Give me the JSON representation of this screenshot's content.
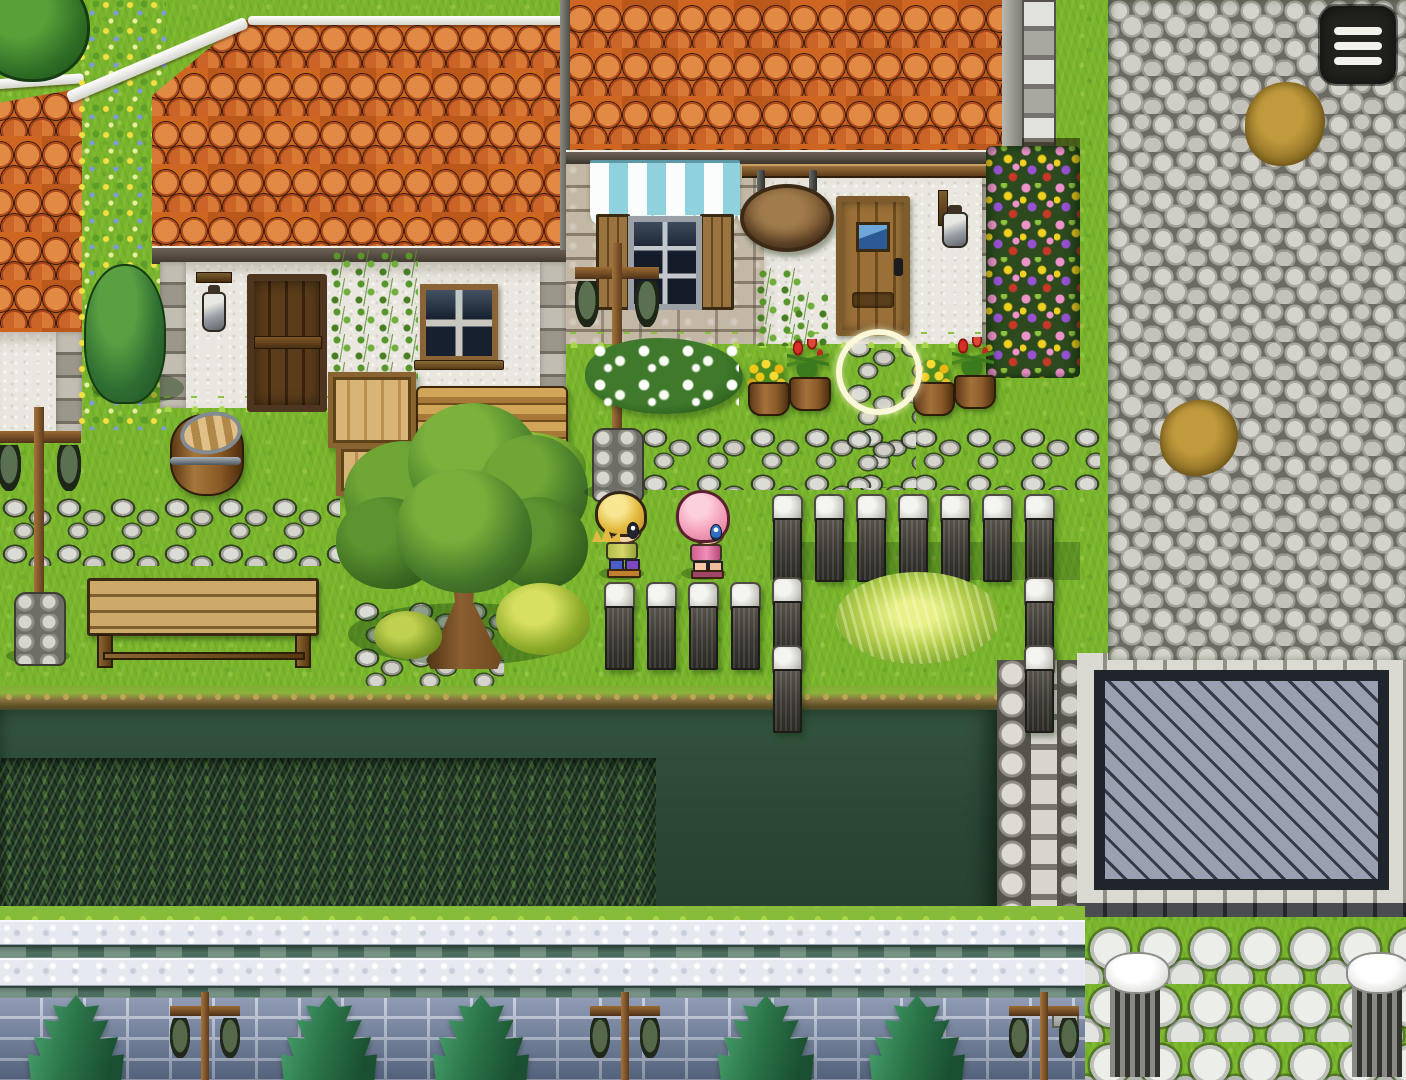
{
  "app": {
    "title": "Top-down RPG village exterior (touch-controlled)",
    "genre": "2D RPG town map"
  },
  "hud": {
    "menu_button": {
      "label": "Menu",
      "icon": "hamburger-menu-icon",
      "bar_count": 3,
      "bg_color": "#23231e",
      "bar_color": "#f2f2ea"
    },
    "touch_indicator": {
      "shape": "circle-ring",
      "x": 836,
      "y": 329,
      "size": 86,
      "color": "#fbf8da"
    }
  },
  "characters": [
    {
      "id": "boy",
      "label": "blond-haired boy villager",
      "facing": "right",
      "x": 594,
      "y": 490,
      "hair_color": "#e3ba41",
      "outfit_color": "#c3cc58"
    },
    {
      "id": "girl",
      "label": "pink-haired girl villager",
      "facing": "right",
      "x": 676,
      "y": 490,
      "hair_color": "#f4a0ba",
      "outfit_color": "#e87aa8"
    }
  ],
  "palette": {
    "grass": "#7ab42e",
    "grass_light": "#9ccf44",
    "grass_dark": "#5c941f",
    "roof": "#c8601f",
    "stucco": "#e9e7df",
    "stone_light": "#d2d2cb",
    "stone_dark": "#62625a",
    "wood": "#8a5d2e",
    "wood_dark": "#4e3318",
    "awning": "#8fd2de",
    "pond": "#2c4a37",
    "crops": "#24392a",
    "brick": "#70809f",
    "canal": "#4c6e60",
    "courtyard": "#98a0b0",
    "pine": "#2a7247",
    "skin": "#f7d4a8",
    "ui_dark": "#23231e",
    "ui_light": "#f2f2ea",
    "ring": "#fbf8da",
    "boy_hair": "#e3ba41",
    "girl_hair": "#f4a0ba"
  },
  "entities": {
    "fence_posts": [
      {
        "x": 772,
        "y": 494
      },
      {
        "x": 814,
        "y": 494
      },
      {
        "x": 856,
        "y": 494
      },
      {
        "x": 898,
        "y": 494
      },
      {
        "x": 940,
        "y": 494
      },
      {
        "x": 982,
        "y": 494
      },
      {
        "x": 1024,
        "y": 494
      },
      {
        "x": 772,
        "y": 577
      },
      {
        "x": 772,
        "y": 645
      },
      {
        "x": 1024,
        "y": 577
      },
      {
        "x": 1024,
        "y": 645
      },
      {
        "x": 604,
        "y": 582
      },
      {
        "x": 646,
        "y": 582
      },
      {
        "x": 688,
        "y": 582
      },
      {
        "x": 730,
        "y": 582
      }
    ],
    "bottom_trees": [
      {
        "x": 28,
        "y": 995
      },
      {
        "x": 281,
        "y": 995
      },
      {
        "x": 433,
        "y": 995
      },
      {
        "x": 718,
        "y": 995
      },
      {
        "x": 869,
        "y": 995
      }
    ],
    "bottom_lamps": [
      {
        "x": 162,
        "y": 990
      },
      {
        "x": 582,
        "y": 990
      },
      {
        "x": 1001,
        "y": 990
      }
    ],
    "garden_lamps": [
      {
        "x": -6,
        "y": 404
      },
      {
        "x": 572,
        "y": 240
      }
    ],
    "flower_pots": [
      {
        "x": 746,
        "y": 352,
        "kind": "yellow"
      },
      {
        "x": 787,
        "y": 339,
        "kind": "tulip"
      },
      {
        "x": 911,
        "y": 352,
        "kind": "yellow"
      },
      {
        "x": 952,
        "y": 337,
        "kind": "tulip"
      }
    ],
    "dirt_patches": [
      {
        "x": 1245,
        "y": 82,
        "w": 80,
        "h": 84
      },
      {
        "x": 1160,
        "y": 400,
        "w": 78,
        "h": 76
      }
    ],
    "stone_pillars": [
      {
        "x": 1106,
        "y": 952
      },
      {
        "x": 1348,
        "y": 952
      }
    ]
  },
  "scene": {
    "regions": [
      "orange-tiled-roof houses",
      "striped shop awning",
      "hanging wooden sign",
      "flower bed",
      "cobblestone plaza",
      "sunken blue-cobble courtyard",
      "dark hedge field",
      "stone canal ledge",
      "blue brick wall with pines",
      "stone fence posts",
      "big garden tree",
      "wooden bench"
    ]
  }
}
